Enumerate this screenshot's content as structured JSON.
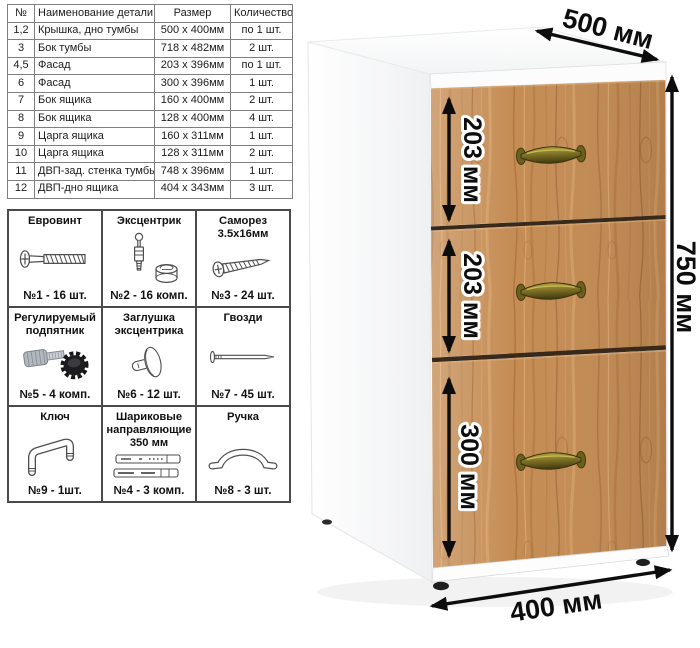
{
  "parts_table": {
    "headers": {
      "num": "№",
      "name": "Наименование детали",
      "size": "Размер",
      "qty": "Количество"
    },
    "rows": [
      {
        "num": "1,2",
        "name": "Крышка, дно тумбы",
        "size": "500 х 400мм",
        "qty": "по 1 шт."
      },
      {
        "num": "3",
        "name": "Бок тумбы",
        "size": "718 х 482мм",
        "qty": "2 шт."
      },
      {
        "num": "4,5",
        "name": "Фасад",
        "size": "203 х 396мм",
        "qty": "по 1 шт."
      },
      {
        "num": "6",
        "name": "Фасад",
        "size": "300 х 396мм",
        "qty": "1 шт."
      },
      {
        "num": "7",
        "name": "Бок ящика",
        "size": "160 х 400мм",
        "qty": "2 шт."
      },
      {
        "num": "8",
        "name": "Бок ящика",
        "size": "128 х 400мм",
        "qty": "4 шт."
      },
      {
        "num": "9",
        "name": "Царга ящика",
        "size": "160 х 311мм",
        "qty": "1 шт."
      },
      {
        "num": "10",
        "name": "Царга ящика",
        "size": "128 х 311мм",
        "qty": "2 шт."
      },
      {
        "num": "11",
        "name": "ДВП-зад. стенка тумбы",
        "size": "748 х 396мм",
        "qty": "1 шт."
      },
      {
        "num": "12",
        "name": "ДВП-дно ящика",
        "size": "404 х 343мм",
        "qty": "3 шт."
      }
    ]
  },
  "hardware": {
    "items": [
      {
        "name": "Евровинт",
        "count": "№1 - 16 шт.",
        "icon": "euro-screw-icon"
      },
      {
        "name": "Эксцентрик",
        "count": "№2 - 16 комп.",
        "icon": "cam-bolt-icon"
      },
      {
        "name": "Саморез 3.5х16мм",
        "count": "№3 - 24 шт.",
        "icon": "self-tapping-screw-icon"
      },
      {
        "name": "Регулируемый подпятник",
        "count": "№5 - 4 комп.",
        "icon": "adjustable-foot-icon"
      },
      {
        "name": "Заглушка эксцентрика",
        "count": "№6 - 12 шт.",
        "icon": "cam-cover-icon"
      },
      {
        "name": "Гвозди",
        "count": "№7 - 45 шт.",
        "icon": "nail-icon"
      },
      {
        "name": "Ключ",
        "count": "№9 - 1шт.",
        "icon": "hex-key-icon"
      },
      {
        "name": "Шариковые направляющие 350 мм",
        "count": "№4 - 3 комп.",
        "icon": "drawer-slides-icon"
      },
      {
        "name": "Ручка",
        "count": "№8 - 3 шт.",
        "icon": "handle-icon"
      }
    ]
  },
  "cabinet": {
    "dims": {
      "depth": "500 мм",
      "height": "750 мм",
      "width": "400 мм",
      "drawer1": "203 мм",
      "drawer2": "203 мм",
      "drawer3": "300 мм"
    },
    "colors": {
      "wood": "#c58c54",
      "wood_dark": "#8a5527",
      "wood_light": "#e2b67c",
      "handle_bronze": "#8a7c28",
      "body_white": "#fafafa",
      "dimension": "#0d0d0d"
    }
  }
}
